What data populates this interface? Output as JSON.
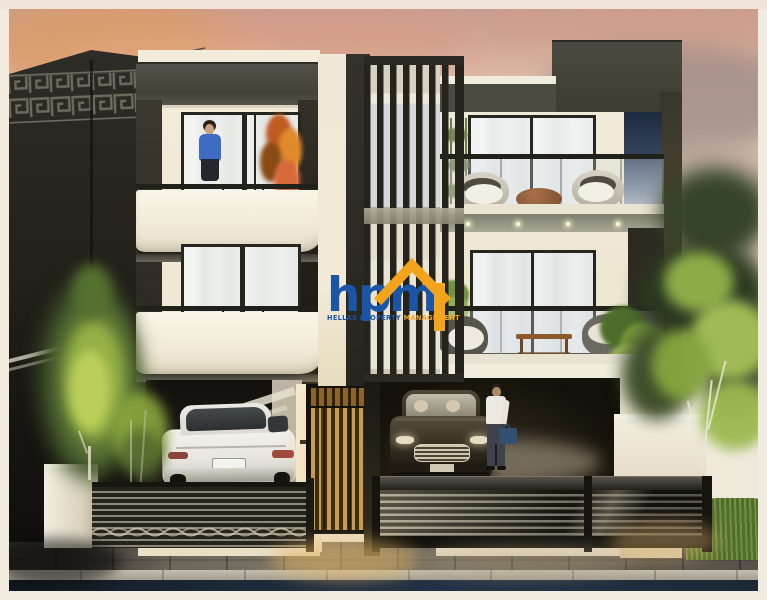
{
  "watermark": {
    "logo_text": "hpm",
    "tagline_left": "HELLAS PROPERTY ",
    "tagline_right": "MANAGEMENT",
    "logo_blue": "#1a55a6",
    "logo_yellow": "#f1a41c"
  },
  "scene": {
    "description": "Dusk architectural rendering of two modern three-storey townhouses: left house with a woman on the balcony and a white coupe in the carport, right house with louvred screen, balcony lounge chairs, and a dark sedan with a businessman in the garage; slatted street fences, trees and a sunset sky; dark neighbouring building with Greek-key frieze at left",
    "palette": {
      "sky_top": "#c39b94",
      "sky_warm": "#e9cdb6",
      "facade_white": "#f2ebd9",
      "facade_dark_band": "#4c4b41",
      "neighbor_building": "#232119",
      "road_navy": "#1d2938",
      "foliage_bright": "#9ab648",
      "foliage_dark": "#35442a",
      "door_glow": "#c79c52",
      "blue_panel": "#37455e"
    }
  }
}
